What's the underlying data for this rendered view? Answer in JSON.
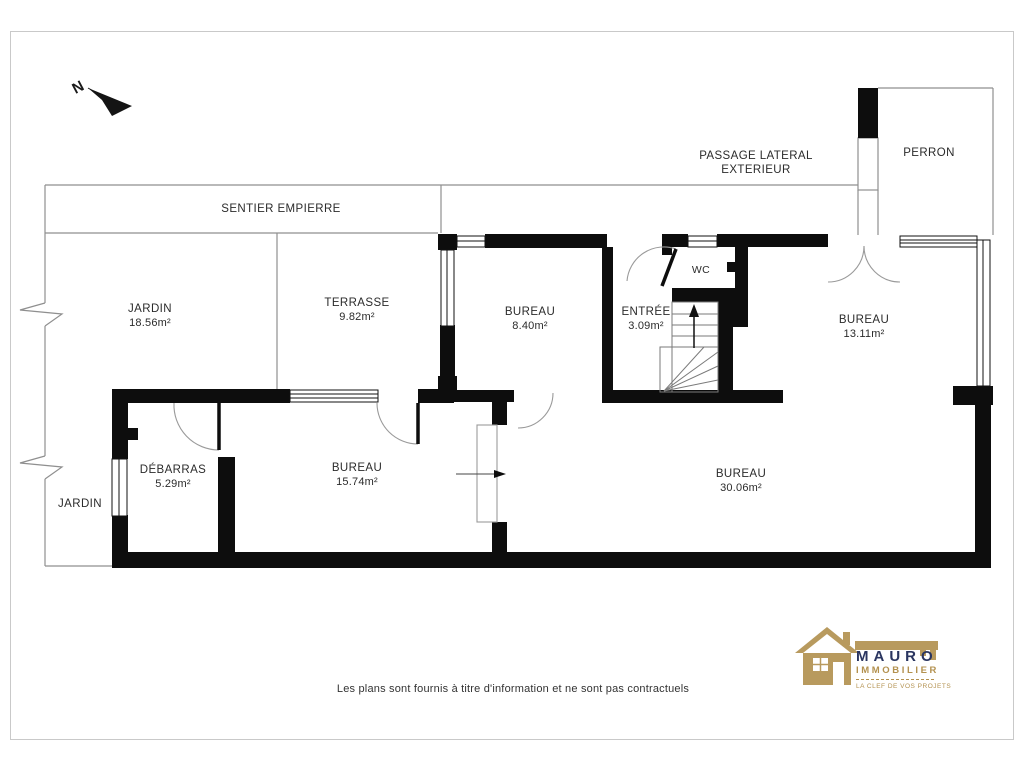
{
  "plan": {
    "north_letter": "N",
    "outdoor": {
      "passage_line1": "PASSAGE LATERAL",
      "passage_line2": "EXTERIEUR",
      "perron": "PERRON",
      "sentier": "SENTIER EMPIERRE",
      "jardin_top": {
        "name": "JARDIN",
        "area": "18.56m²"
      },
      "terrasse": {
        "name": "TERRASSE",
        "area": "9.82m²"
      },
      "jardin_side": {
        "name": "JARDIN"
      }
    },
    "rooms": {
      "bureau_nw": {
        "name": "BUREAU",
        "area": "8.40m²"
      },
      "entree": {
        "name": "ENTRÉE",
        "area": "3.09m²"
      },
      "wc": {
        "name": "WC"
      },
      "bureau_ne": {
        "name": "BUREAU",
        "area": "13.11m²"
      },
      "debarras": {
        "name": "DÉBARRAS",
        "area": "5.29m²"
      },
      "bureau_sw": {
        "name": "BUREAU",
        "area": "15.74m²"
      },
      "bureau_se": {
        "name": "BUREAU",
        "area": "30.06m²"
      }
    }
  },
  "footer": {
    "disclaimer": "Les plans sont fournis à titre d'information et ne sont pas contractuels"
  },
  "logo": {
    "brand": "MAURO",
    "subtitle": "IMMOBILIER",
    "tagline": "LA CLEF DE VOS PROJETS",
    "colors": {
      "gold": "#b3914f",
      "navy": "#2a3560"
    }
  }
}
